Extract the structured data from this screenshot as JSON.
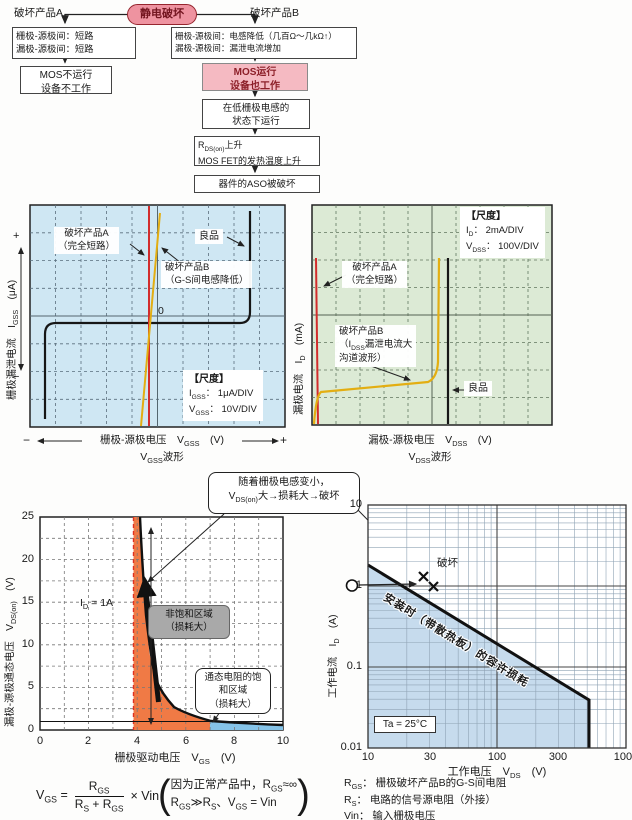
{
  "flowchart": {
    "esd": "静电破坏",
    "product_a": "破坏产品A",
    "product_b": "破坏产品B",
    "box_a1": [
      "栅极-源极间：短路",
      "漏极-源极间：短路"
    ],
    "box_b1": [
      "栅极-源极间：电感降低（几百Ω～几kΩ↑）",
      "漏极-源极间：漏泄电流增加"
    ],
    "box_a2": [
      "MOS不运行",
      "设备不工作"
    ],
    "box_b2": [
      "MOS运行",
      "设备也工作"
    ],
    "box_b3": [
      "在低栅极电感的",
      "状态下运行"
    ],
    "box_b4_html": [
      "R<sub>DS(on)</sub>上升",
      "MOS FET的发热温度上升"
    ],
    "box_b5": "器件的ASO被破坏"
  },
  "gate_chart": {
    "label_a": [
      "破坏产品A",
      "（完全短路）"
    ],
    "label_b": [
      "破坏产品B",
      "（G-S间电感降低）"
    ],
    "label_good": "良品",
    "zero": "0",
    "scale_title": "【尺度】",
    "scale_lines_html": [
      "I<sub>GSS</sub>： 1μA/DIV",
      "V<sub>GSS</sub>： 10V/DIV"
    ],
    "xlabel_html": "栅极-源极电压　V<sub>GSS</sub>　(V)",
    "xwave_html": "V<sub>GSS</sub>波形",
    "ylabel_html": "栅极漏泄电流　I<sub>GSS</sub>　(μA)",
    "plus": "+",
    "minus": "−"
  },
  "drain_chart": {
    "label_a": [
      "破坏产品A",
      "（完全短路）"
    ],
    "label_b_html": [
      "破坏产品B",
      "（I<sub>DSS</sub>漏泄电流大",
      "沟道波形）"
    ],
    "label_good": "良品",
    "scale_title": "【尺度】",
    "scale_lines_html": [
      "I<sub>D</sub>： 2mA/DIV",
      "V<sub>DSS</sub>： 100V/DIV"
    ],
    "xlabel_html": "漏极-源极电压　V<sub>DSS</sub>　(V)",
    "xwave_html": "V<sub>DSS</sub>波形",
    "ylabel_html": "漏极电流　I<sub>D</sub>　(mA)"
  },
  "callout_html": [
    "随着栅极电感变小，",
    "V<sub>DS(on)</sub>大→损耗大→破坏"
  ],
  "vgs_chart": {
    "yticks": [
      "25",
      "20",
      "15",
      "10",
      "5",
      "0"
    ],
    "xticks": [
      "0",
      "2",
      "4",
      "6",
      "8",
      "10"
    ],
    "ylabel_html": "漏极-源极通态电压　V<sub>DS(on)</sub>　(V)",
    "xlabel_html": "栅极驱动电压　V<sub>GS</sub>　(V)",
    "id_label_html": "I<sub>D</sub> = 1A",
    "nonsat_label": [
      "非饱和区域",
      "（损耗大）"
    ],
    "sat_label": [
      "通态电阻的饱",
      "和区域",
      "（损耗大）"
    ]
  },
  "aso_chart": {
    "yticks": [
      "10",
      "1",
      "0.1",
      "0.01"
    ],
    "xticks": [
      "10",
      "30",
      "100",
      "300",
      "1000"
    ],
    "ylabel_html": "工作电流　I<sub>D</sub>　(A)",
    "xlabel_html": "工作电压　V<sub>DS</sub>　(V)",
    "damage": "破坏",
    "diag_label": "安装时（带散热板）的容许损耗",
    "ta": "Ta = 25°C"
  },
  "formula": {
    "lhs_html": "V<sub>GS</sub> =",
    "numerator_html": "R<sub>GS</sub>",
    "denominator_html": "R<sub>S</sub> + R<sub>GS</sub>",
    "times_html": "× Vin",
    "paren_open": "(",
    "paren_close": ")",
    "note_html": [
      "因为正常产品中，R<sub>GS</sub>≈∞",
      "R<sub>GS</sub>≫R<sub>S</sub>、V<sub>GS</sub> = Vin"
    ]
  },
  "legend": {
    "rows_html": [
      "R<sub>GS</sub>： 栅极破坏产品B的G-S间电阻",
      "R<sub>S</sub>： 电路的信号源电阻（外接）",
      "Vin： 输入栅极电压"
    ]
  },
  "colors": {
    "pink_node": "#ee93a0",
    "pink_box": "#f5bac2",
    "scope_blue_bg": "#cfe7f3",
    "scope_green_bg": "#dcead5",
    "trace_red": "#d22c2c",
    "trace_yellow": "#e3ae12",
    "region_orange": "#f07a45",
    "region_blue": "#85c3e8",
    "aso_region_blue": "#c6dbed"
  },
  "chart_data": [
    {
      "id": "gate-waveform",
      "type": "line",
      "title": "VGSS波形",
      "xlabel": "栅极-源极电压 VGSS (V)",
      "ylabel": "栅极漏泄电流 IGSS (μA)",
      "scale": {
        "IGSS": "1μA/DIV",
        "VGSS": "10V/DIV"
      },
      "series": [
        {
          "name": "良品",
          "points_div": [
            [
              -4.4,
              -3.7
            ],
            [
              -4.4,
              -0.3
            ],
            [
              3.7,
              -0.3
            ],
            [
              3.7,
              3.9
            ]
          ],
          "note": "平坦的漏泄电流，两端击穿上升"
        },
        {
          "name": "破坏产品A（完全短路）",
          "points_div": [
            [
              -0.3,
              -4
            ],
            [
              -0.3,
              4
            ]
          ],
          "note": "通过0V的垂直线"
        },
        {
          "name": "破坏产品B（G-S间电感降低）",
          "points_div": [
            [
              -0.7,
              -4
            ],
            [
              0.1,
              3.9
            ]
          ],
          "note": "稍倾斜的近垂直线"
        }
      ]
    },
    {
      "id": "drain-waveform",
      "type": "line",
      "title": "VDSS波形",
      "xlabel": "漏极-源极电压 VDSS (V)",
      "ylabel": "漏极电流 ID (mA)",
      "scale": {
        "ID": "2mA/DIV",
        "VDSS": "100V/DIV"
      },
      "series": [
        {
          "name": "破坏产品A（完全短路）",
          "note": "最左端的近垂直线"
        },
        {
          "name": "破坏产品B（IDSS漏泄电流大，沟道波形）",
          "note": "漏泄电流沿横轴缓升后急剧上升"
        },
        {
          "name": "良品",
          "note": "中部（约5格处）的垂直击穿线"
        }
      ]
    },
    {
      "id": "vdson-vs-vgs",
      "type": "line",
      "xlabel": "栅极驱动电压 VGS (V)",
      "ylabel": "漏极-源极通态电压 VDS(on) (V)",
      "xlim": [
        0,
        10
      ],
      "ylim": [
        0,
        25
      ],
      "condition": "ID = 1A",
      "x": [
        4.1,
        4.3,
        4.5,
        4.75,
        5,
        5.5,
        6,
        6.5,
        7,
        8,
        9,
        10
      ],
      "y": [
        25,
        15,
        9,
        6,
        4.4,
        2.7,
        1.9,
        1.4,
        1.1,
        0.85,
        0.7,
        0.6
      ],
      "ref_line_y": 1,
      "regions": [
        {
          "name": "非饱和区域（损耗大）",
          "x_range": [
            3.9,
            7
          ],
          "color": "#f07a45"
        },
        {
          "name": "通态电阻的饱和区域（损耗大）",
          "x_range": [
            7,
            10
          ],
          "color": "#85c3e8"
        }
      ]
    },
    {
      "id": "aso",
      "type": "line",
      "scale": "log-log",
      "xlabel": "工作电压 VDS (V)",
      "ylabel": "工作电流 ID (A)",
      "xlim": [
        10,
        1000
      ],
      "ylim": [
        0.01,
        10
      ],
      "temperature": "Ta = 25°C",
      "allowable_loss_line": {
        "name": "安装时（带散热板）的容许损耗",
        "x": [
          10,
          500,
          500
        ],
        "y": [
          1.8,
          0.04,
          0.01
        ]
      },
      "operating_point": {
        "x": 10,
        "y": 1
      },
      "damage_points": [
        {
          "x": 27,
          "y": 1.2
        },
        {
          "x": 30,
          "y": 0.95
        }
      ]
    }
  ]
}
